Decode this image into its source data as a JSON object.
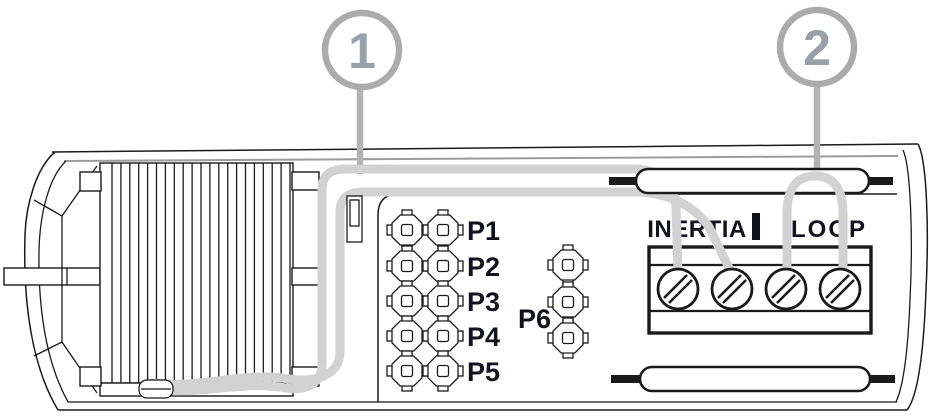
{
  "diagram": {
    "kind": "sensor-wiring-diagram",
    "callouts": [
      {
        "number": "1"
      },
      {
        "number": "2"
      }
    ],
    "jumpers": {
      "labels": [
        "P1",
        "P2",
        "P3",
        "P4",
        "P5"
      ],
      "p6_label": "P6",
      "rows": 5,
      "cols": 2,
      "p6_pins": 3
    },
    "terminal_block": {
      "labels": [
        "INERTIA",
        "LOOP"
      ],
      "separator": "|",
      "screw_count": 4
    },
    "coil": {
      "fin_count": 21
    },
    "colors": {
      "wire": "#d2d2d2",
      "leader": "#b3b3b3",
      "callout_ring": "#ababab",
      "callout_number": "#99a0a8",
      "ink": "#1a1a1a",
      "text": "#12121c"
    }
  }
}
